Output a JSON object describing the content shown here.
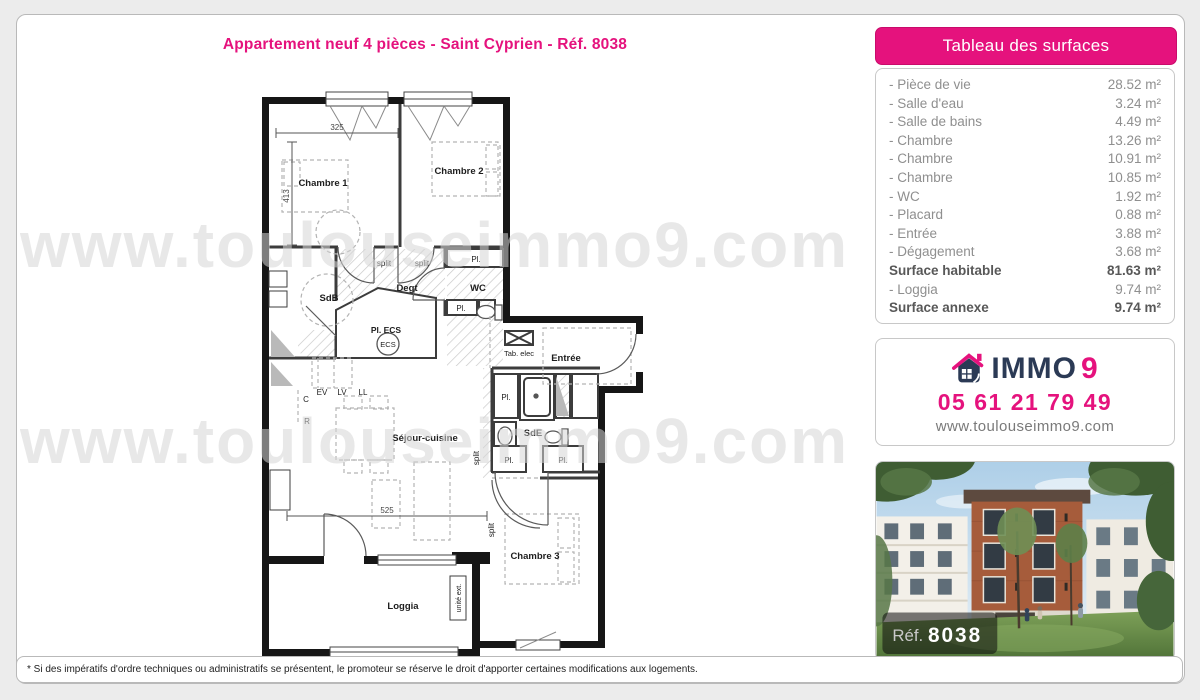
{
  "title": "Appartement neuf 4 pièces - Saint Cyprien - Réf. 8038",
  "watermark": "www.toulouseimmo9.com",
  "footnote": "* Si des impératifs d'ordre techniques ou administratifs se présentent, le promoteur se réserve le droit d'apporter certaines modifications aux logements.",
  "surfaces": {
    "header": "Tableau des surfaces",
    "rows": [
      {
        "label": "- Pièce de vie",
        "value": "28.52 m²"
      },
      {
        "label": "- Salle d'eau",
        "value": "3.24 m²"
      },
      {
        "label": "- Salle de bains",
        "value": "4.49 m²"
      },
      {
        "label": "- Chambre",
        "value": "13.26 m²"
      },
      {
        "label": "- Chambre",
        "value": "10.91 m²"
      },
      {
        "label": "- Chambre",
        "value": "10.85 m²"
      },
      {
        "label": "- WC",
        "value": "1.92 m²"
      },
      {
        "label": "- Placard",
        "value": "0.88 m²"
      },
      {
        "label": "- Entrée",
        "value": "3.88 m²"
      },
      {
        "label": "- Dégagement",
        "value": "3.68 m²"
      },
      {
        "label": "Surface habitable",
        "value": "81.63 m²"
      },
      {
        "label": "- Loggia",
        "value": "9.74 m²"
      },
      {
        "label": "Surface annexe",
        "value": "9.74 m²"
      }
    ]
  },
  "contact": {
    "brand": "IMMO",
    "brand_digit": "9",
    "phone": "05 61 21 79 49",
    "website": "www.toulouseimmo9.com"
  },
  "photo": {
    "ref_label": "Réf.",
    "ref_value": "8038"
  },
  "plan": {
    "labels": {
      "chambre1": "Chambre 1",
      "chambre2": "Chambre 2",
      "chambre3": "Chambre 3",
      "sdb": "SdB",
      "degt": "Degt",
      "wc": "WC",
      "pl": "Pl.",
      "pl_ecs": "Pl. ECS",
      "ecs": "ECS",
      "tab_elec": "Tab. elec",
      "entree": "Entrée",
      "sde": "SdE",
      "sejour": "Séjour-cuisine",
      "loggia": "Loggia",
      "split": "split",
      "ev": "EV",
      "lv": "LV",
      "ll": "LL",
      "c": "C",
      "r": "R",
      "unite_ext": "unité ext."
    },
    "dims": {
      "top": "325",
      "left": "413",
      "bottom": "525"
    }
  },
  "colors": {
    "accent": "#e5127d",
    "brand_navy": "#2b3a55"
  }
}
